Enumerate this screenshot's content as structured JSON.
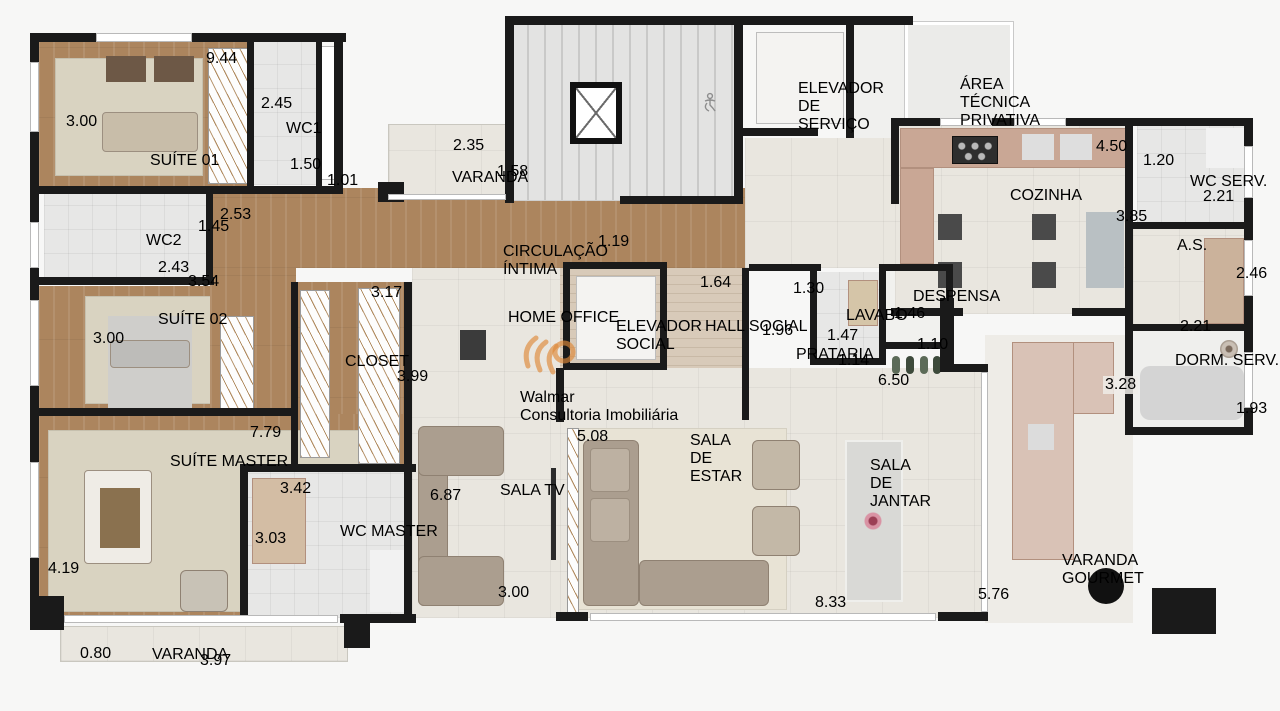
{
  "watermark": {
    "brand": "Walmar",
    "tagline": "Consultoria Imobiliária"
  },
  "rooms": {
    "suite01": {
      "label": "SUÍTE 01"
    },
    "wc1": {
      "label": "WC1"
    },
    "wc2": {
      "label": "WC2"
    },
    "suite02": {
      "label": "SUÍTE 02"
    },
    "closet": {
      "label": "CLOSET"
    },
    "suite_master": {
      "label": "SUÍTE MASTER"
    },
    "wc_master": {
      "label": "WC MASTER"
    },
    "varanda_suite": {
      "label": "VARANDA"
    },
    "varanda_top": {
      "label": "VARANDA"
    },
    "circulacao_intima": {
      "label": "CIRCULAÇÃO ÍNTIMA"
    },
    "home_office": {
      "label": "HOME OFFICE"
    },
    "sala_tv": {
      "label": "SALA TV"
    },
    "elevador_social": {
      "label": "ELEVADOR SOCIAL"
    },
    "hall_social": {
      "label": "HALL SOCIAL"
    },
    "prataria": {
      "label": "PRATARIA"
    },
    "lavabo": {
      "label": "LAVABO"
    },
    "despensa": {
      "label": "DESPENSA"
    },
    "elevador_servico": {
      "label": "ELEVADOR DE SERVIÇO"
    },
    "area_tecnica": {
      "label": "ÁREA TÉCNICA PRIVATIVA"
    },
    "cozinha": {
      "label": "COZINHA"
    },
    "wc_serv": {
      "label": "WC SERV."
    },
    "area_servico": {
      "label": "A.S."
    },
    "dorm_serv": {
      "label": "DORM. SERV."
    },
    "sala_estar": {
      "label": "SALA DE ESTAR"
    },
    "sala_jantar": {
      "label": "SALA DE JANTAR"
    },
    "varanda_gourmet": {
      "label": "VARANDA GOURMET"
    }
  },
  "dimensions": {
    "suite01_top": "9.44",
    "suite01_left": "3.00",
    "wc1_left": "2.45",
    "wc1_bottom": "1.50",
    "shaft": "1.01",
    "hall_suites": "2.53",
    "wc2_right": "1.45",
    "wc2_bottom": "2.43",
    "suite02_top": "3.54",
    "suite02_left": "3.00",
    "closet_top": "3.17",
    "closet_right": "3.99",
    "master_top": "7.79",
    "master_left": "4.19",
    "wc_master_top": "3.42",
    "wc_master_left": "3.03",
    "varanda_suite_left": "0.80",
    "varanda_suite_bottom": "3.97",
    "varanda_top_w": "2.35",
    "varanda_top_h": "1.58",
    "circulacao": "1.19",
    "sala_tv_left": "6.87",
    "sala_tv_bottom": "3.00",
    "hall_social_top": "1.64",
    "lavabo_hall": "1.30",
    "prataria_h": "1.96",
    "lavabo_left": "1.47",
    "lavabo_bottom": "1.14",
    "despensa_left": "1.46",
    "despensa_bottom": "1.10",
    "social_depth": "6.50",
    "cozinha_top": "4.50",
    "cozinha_right": "3.85",
    "wc_serv_left": "1.20",
    "wc_serv_bottom": "2.21",
    "as_right": "2.46",
    "as_bottom": "2.21",
    "churrasqueira": "3.28",
    "dorm_serv_right": "1.93",
    "sala_estar_left": "5.08",
    "sala_bottom": "8.33",
    "gourmet_left": "5.76"
  }
}
